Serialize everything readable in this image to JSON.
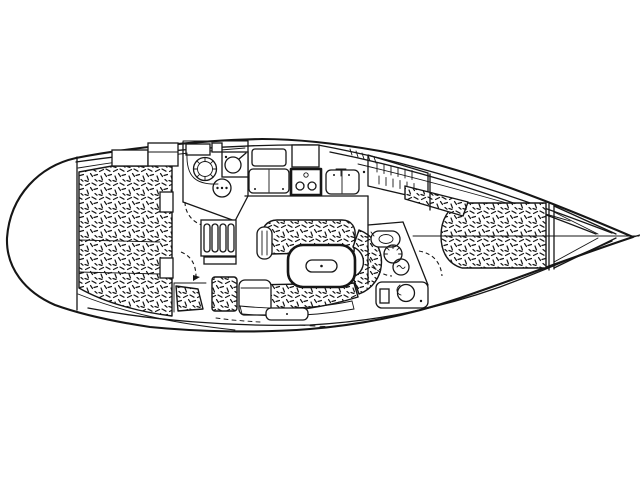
{
  "canvas": {
    "width": 640,
    "height": 480
  },
  "colors": {
    "ink": "#161616",
    "paper": "#ffffff"
  },
  "drawing": {
    "kind": "sailboat interior layout floor plan",
    "style": "black ink line drawing, overhead view",
    "orientation": {
      "bow": "right",
      "stern": "left"
    },
    "cushion_texture": "random short-dash hatching",
    "areas": [
      {
        "name": "aft-cabin",
        "features": [
          "large double berth with hatched cushion",
          "storage cabinets"
        ]
      },
      {
        "name": "aft-head",
        "features": [
          "round wash basin",
          "marine toilet with pump handle",
          "shower fixture"
        ]
      },
      {
        "name": "companionway",
        "features": [
          "four-tread ladder",
          "engine box",
          "door swing arc"
        ]
      },
      {
        "name": "galley",
        "features": [
          "icebox with twin lids",
          "two-burner stove",
          "double sink with faucet"
        ]
      },
      {
        "name": "salon",
        "features": [
          "C-shaped settee with hatched cushions",
          "dining table with center insert",
          "support pillar"
        ]
      },
      {
        "name": "nav-station",
        "features": [
          "chart table",
          "hatched seat cushion"
        ]
      },
      {
        "name": "hanging-locker",
        "features": [
          "two rows of hanger tick marks"
        ]
      },
      {
        "name": "forward-head",
        "features": [
          "small wash basin",
          "marine toilet",
          "vanity with round basin"
        ]
      },
      {
        "name": "forward-cabin",
        "features": [
          "double V-berth with hatched cushion",
          "hatched side shelf",
          "door swing arc"
        ]
      },
      {
        "name": "bow",
        "features": [
          "anchor locker bulkhead",
          "converging deck and toe-rail lines",
          "stem fitting"
        ]
      }
    ]
  }
}
